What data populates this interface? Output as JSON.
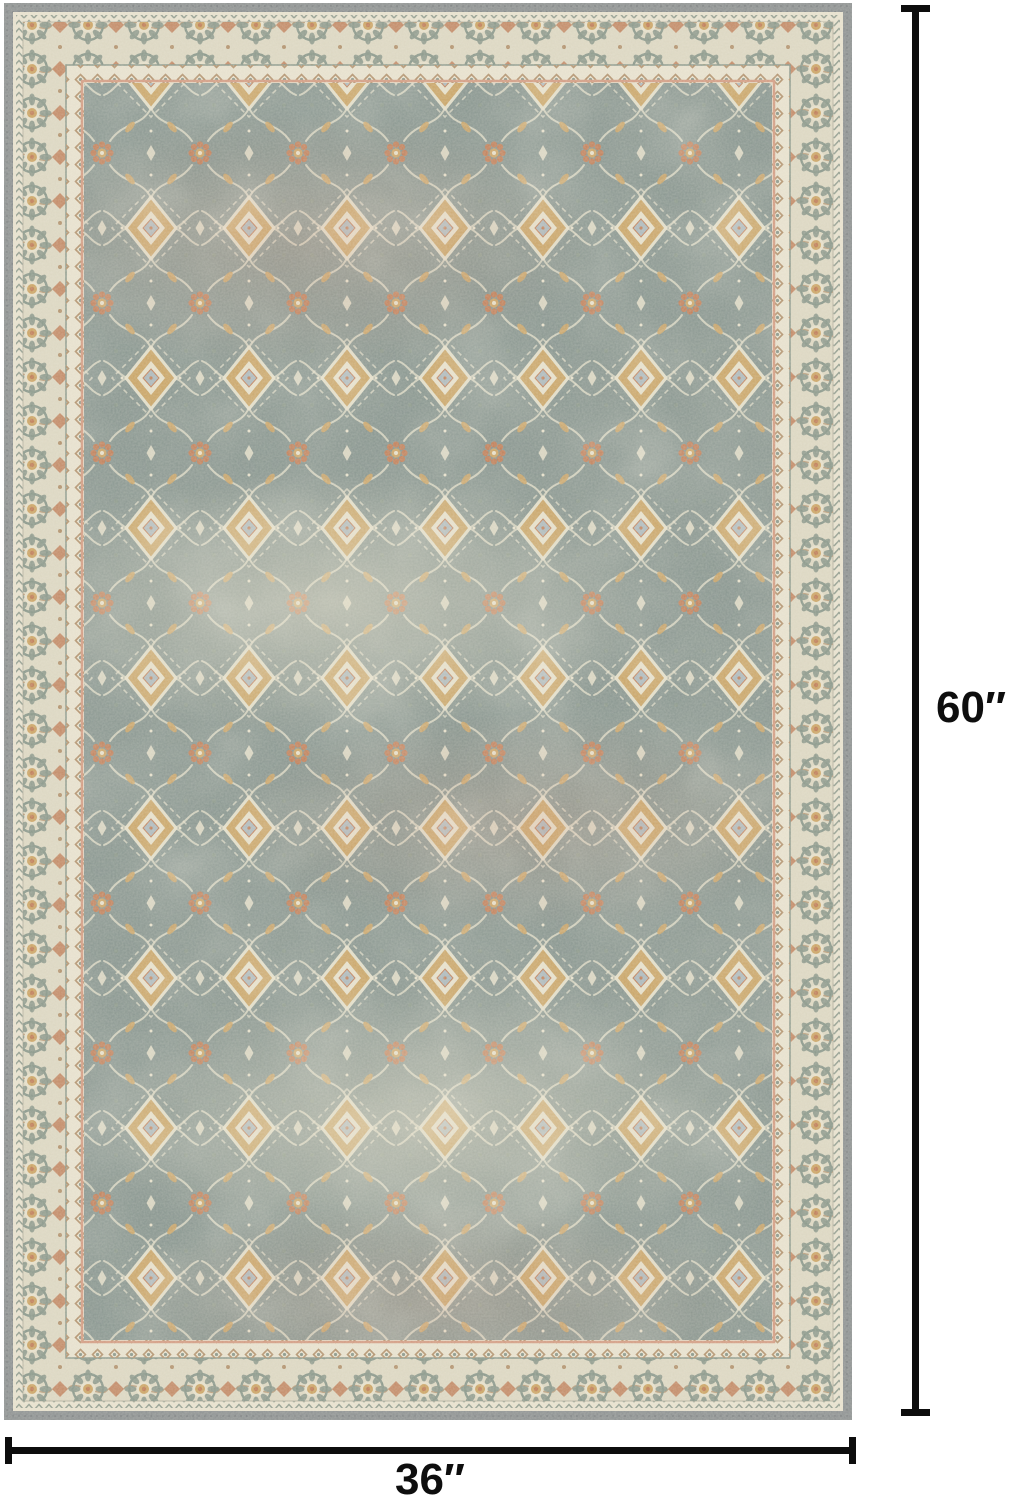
{
  "page": {
    "background": "#ffffff"
  },
  "rug": {
    "description": "Vintage Persian-style area rug: distressed sage-green field with all-over gold, rust and cream floral medallion pattern, cream ornamental borders and a grey serged edge",
    "colors": {
      "edge_grey": "#8b8f90",
      "edge_stitch": "#6d7173",
      "cream_light": "#ebe4d0",
      "border_cream": "#dfd9c3",
      "sage": "#879588",
      "sage_deep": "#6e8178",
      "field_green": "#84928c",
      "gold": "#cda25f",
      "rust": "#c07a52",
      "blush": "#d59a80",
      "blue_core": "#aab7bc",
      "tan": "#b2906a",
      "cream_motif": "#e9e2cc"
    }
  },
  "dimensions": {
    "line_color": "#0d0d0d",
    "height": {
      "label": "60″"
    },
    "width": {
      "label": "36″"
    }
  }
}
